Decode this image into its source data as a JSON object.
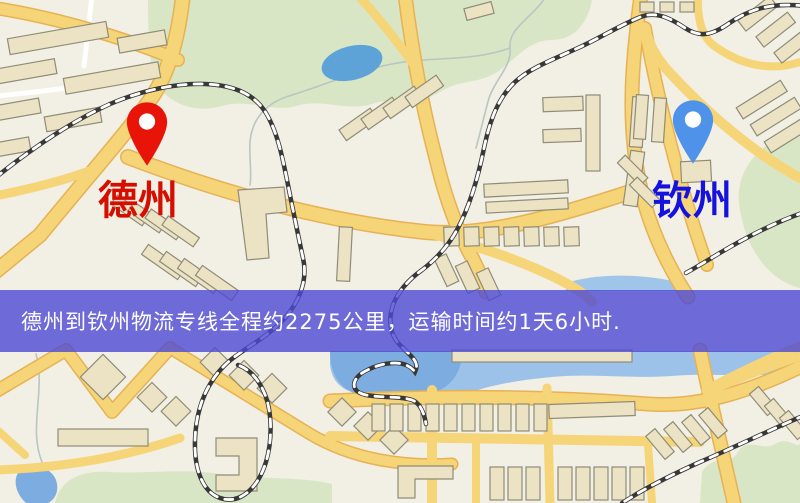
{
  "map": {
    "origin": {
      "name": "德州"
    },
    "destination": {
      "name": "钦州"
    },
    "banner": {
      "text": "德州到钦州物流专线全程约2275公里，运输时间约1天6小时."
    },
    "colors": {
      "origin_pin": "#e91408",
      "origin_label": "#d60e00",
      "destination_pin": "#4f92ea",
      "destination_label": "#1512dd",
      "banner_background": "#4c48d4",
      "banner_text": "#ffffff",
      "road": "#f6d478",
      "road_casing": "#e6b254",
      "water": "#7dade0",
      "park": "#d9e6c6",
      "building": "#ece3c4",
      "background": "#f2efe4"
    },
    "icons": {
      "origin_pin": "map-pin-icon",
      "destination_pin": "map-pin-icon"
    }
  }
}
